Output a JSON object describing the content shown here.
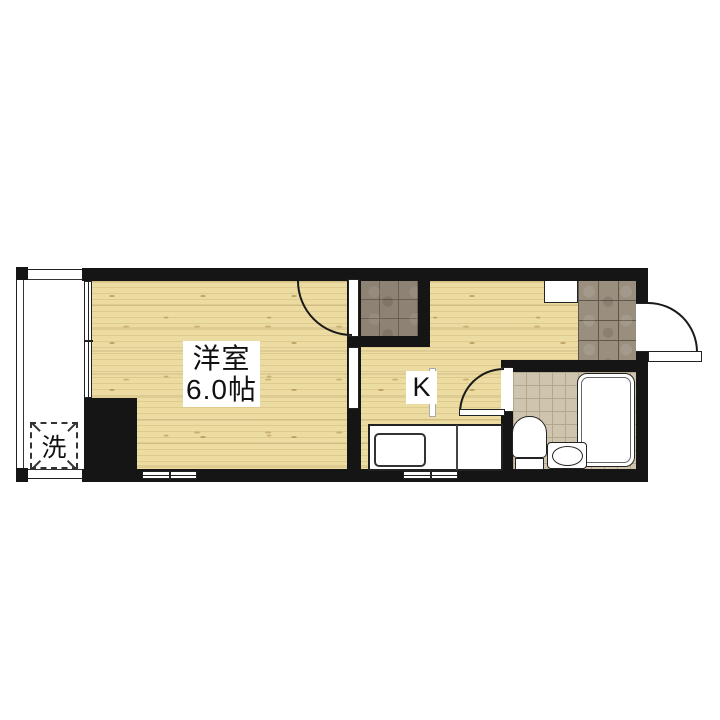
{
  "floorplan": {
    "type": "apartment-floor-plan",
    "rooms": {
      "western_room": {
        "name": "洋室",
        "size": "6.0帖"
      },
      "kitchen": {
        "label": "K"
      },
      "laundry": {
        "label": "洗"
      }
    },
    "fixtures": {
      "balcony": "balcony-strip",
      "washing_machine_space": "dashed-pan",
      "closet": "tiled-storage",
      "genkan": "tiled-entrance",
      "shoe_cabinet": "white-box",
      "entrance_door": "swing-door",
      "room_door": "swing-door",
      "bathroom_door": "swing-door",
      "kitchen_counter": "counter-with-sink",
      "bathtub": "bathtub",
      "toilet": "toilet",
      "sink": "wash-basin",
      "windows": [
        "left-wall-window",
        "bottom-window-1",
        "bottom-window-2"
      ]
    },
    "colors": {
      "wall": "#151515",
      "wood_floor": "#ecdca2",
      "genkan_tile": "#9a8f7e",
      "closet_tile": "#8d8273",
      "bath_tile": "#cfc5af",
      "background": "#ffffff"
    }
  }
}
